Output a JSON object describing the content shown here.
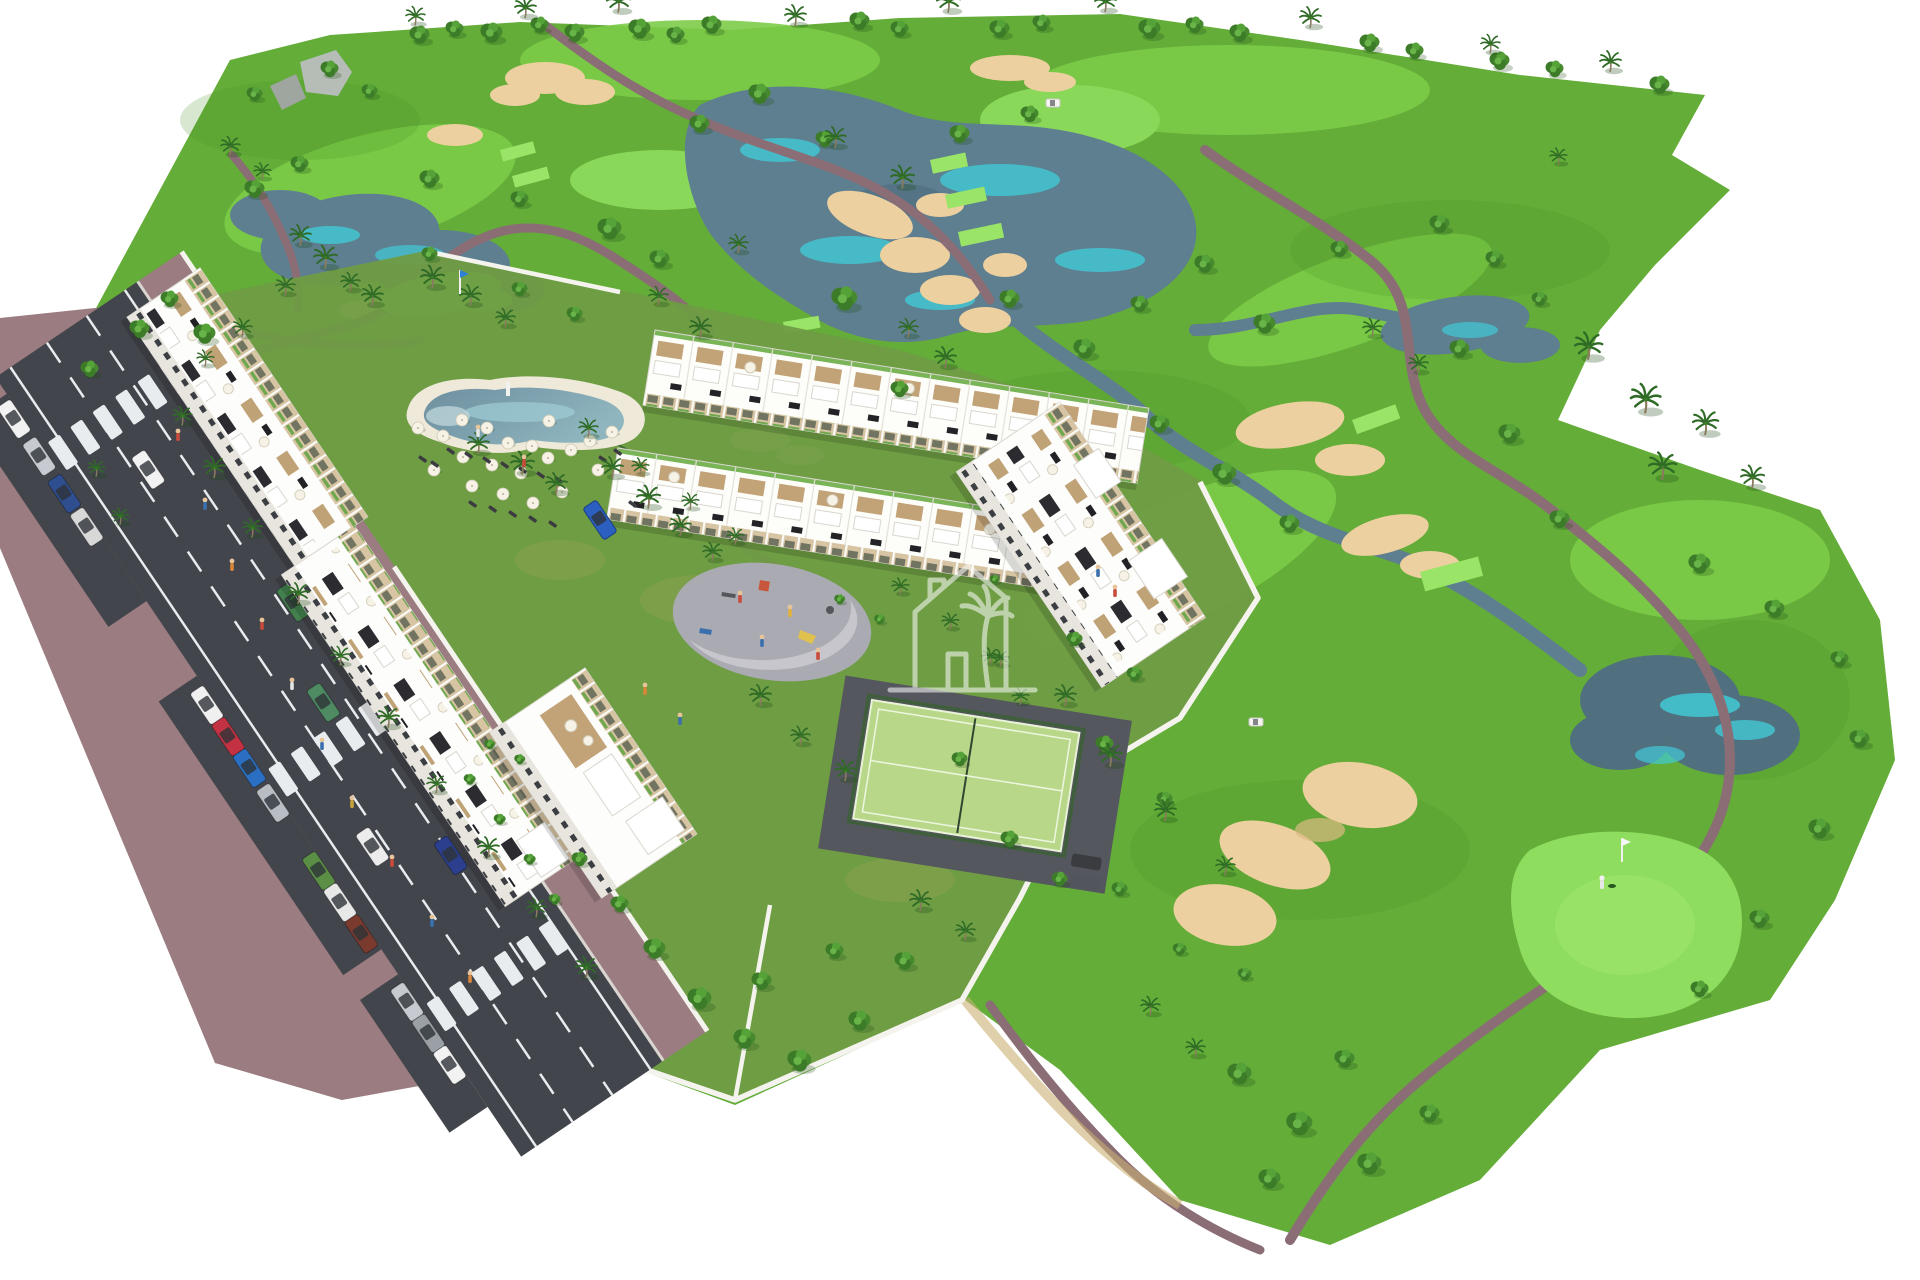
{
  "meta": {
    "title": "Aerial 3D architectural render of a golf resort residential development",
    "scene_type": "computer-generated aerial masterplan visualization",
    "background": "#ffffff"
  },
  "colors": {
    "grass_base": "#63ad38",
    "grass_bright": "#7ccc49",
    "grass_light": "#8edd5f",
    "grass_dark": "#4c922b",
    "grass_tee": "#9ae468",
    "lawn": "#6f9c44",
    "water": "#5e7f90",
    "water_deep": "#51707f",
    "water_accent": "#41c9d5",
    "sand": "#edd0a0",
    "sand_dark": "#ddb985",
    "path": "#8b6d75",
    "road": "#42454b",
    "sidewalk": "#9b7c80",
    "curb": "#d9d5d0",
    "marking": "#e9ecee",
    "wall": "#f5f3ee",
    "building": "#fdfdfb",
    "building_shade": "#e6e2da",
    "facade": "#d7c4a2",
    "roof_dark": "#2c2c30",
    "deck": "#c2a277",
    "green_roof": "#79b457",
    "court": "#b9d788",
    "court_fence": "#3f5f3c",
    "plaza": "#aaaab2",
    "plaza_light": "#c6c6cc",
    "pool_deck": "#efe9da",
    "rock": "#b6bcb6",
    "watermark": "#ffffff",
    "tree": "#3c7c28",
    "palm": "#2f6b26",
    "flag_blue": "#2f7fd6",
    "flag_white": "#f6f6f6"
  },
  "landmarks": {
    "golf_course": "18-hole golf course with lakes, sand bunkers and cart paths",
    "apartments": "white apartment blocks along access road",
    "townhouses": "two rows of townhouses with roof terraces",
    "pool": "lagoon-style swimming pool with sun loungers",
    "padel_court": "fenced padel court",
    "playground": "children's playground plaza",
    "road": "two-lane access road with parallel parking",
    "watermark": "house-with-palm developer watermark"
  },
  "scene": {
    "crosswalks": [
      40,
      434,
      717
    ],
    "trees": [
      [
        420,
        36,
        1.0
      ],
      [
        455,
        30,
        0.9
      ],
      [
        492,
        34,
        1.1
      ],
      [
        540,
        26,
        0.9
      ],
      [
        575,
        34,
        1.0
      ],
      [
        640,
        30,
        1.1
      ],
      [
        676,
        36,
        0.9
      ],
      [
        712,
        26,
        1.0
      ],
      [
        860,
        22,
        1.0
      ],
      [
        900,
        30,
        0.9
      ],
      [
        1000,
        30,
        1.0
      ],
      [
        1042,
        24,
        0.9
      ],
      [
        1150,
        30,
        1.1
      ],
      [
        1195,
        26,
        0.9
      ],
      [
        1240,
        34,
        1.0
      ],
      [
        1370,
        44,
        1.0
      ],
      [
        1415,
        52,
        0.9
      ],
      [
        1500,
        62,
        1.0
      ],
      [
        1555,
        70,
        0.9
      ],
      [
        1660,
        86,
        1.0
      ],
      [
        140,
        330,
        1.0
      ],
      [
        170,
        300,
        0.9
      ],
      [
        205,
        335,
        1.1
      ],
      [
        90,
        370,
        0.9
      ],
      [
        255,
        190,
        1.0
      ],
      [
        300,
        165,
        0.9
      ],
      [
        430,
        180,
        1.0
      ],
      [
        520,
        200,
        0.9
      ],
      [
        610,
        230,
        1.2
      ],
      [
        660,
        260,
        1.0
      ],
      [
        700,
        125,
        1.0
      ],
      [
        760,
        95,
        1.1
      ],
      [
        825,
        140,
        0.9
      ],
      [
        960,
        135,
        1.0
      ],
      [
        1030,
        115,
        0.9
      ],
      [
        845,
        300,
        1.3
      ],
      [
        1010,
        300,
        1.0
      ],
      [
        1085,
        350,
        1.1
      ],
      [
        1140,
        305,
        0.9
      ],
      [
        1205,
        265,
        1.0
      ],
      [
        1265,
        325,
        1.1
      ],
      [
        1160,
        425,
        1.0
      ],
      [
        1225,
        475,
        1.2
      ],
      [
        1290,
        525,
        1.0
      ],
      [
        900,
        390,
        0.9
      ],
      [
        1340,
        250,
        0.9
      ],
      [
        1440,
        225,
        1.0
      ],
      [
        1495,
        260,
        0.9
      ],
      [
        1540,
        300,
        0.8
      ],
      [
        1460,
        350,
        1.0
      ],
      [
        1510,
        435,
        1.1
      ],
      [
        1560,
        520,
        1.0
      ],
      [
        1700,
        565,
        1.1
      ],
      [
        1775,
        610,
        1.0
      ],
      [
        1840,
        660,
        0.9
      ],
      [
        1860,
        740,
        1.0
      ],
      [
        1820,
        830,
        1.1
      ],
      [
        1760,
        920,
        1.0
      ],
      [
        1700,
        990,
        0.9
      ],
      [
        1240,
        1075,
        1.2
      ],
      [
        1300,
        1125,
        1.3
      ],
      [
        1370,
        1165,
        1.2
      ],
      [
        1430,
        1115,
        1.0
      ],
      [
        1345,
        1060,
        1.0
      ],
      [
        1270,
        1180,
        1.1
      ],
      [
        1180,
        950,
        0.7
      ],
      [
        1245,
        975,
        0.7
      ],
      [
        1120,
        890,
        0.8
      ],
      [
        655,
        950,
        1.1
      ],
      [
        700,
        1000,
        1.2
      ],
      [
        745,
        1040,
        1.1
      ],
      [
        800,
        1062,
        1.2
      ],
      [
        860,
        1022,
        1.1
      ],
      [
        905,
        962,
        1.0
      ],
      [
        835,
        952,
        0.9
      ],
      [
        762,
        982,
        1.0
      ],
      [
        620,
        905,
        0.9
      ],
      [
        580,
        860,
        0.8
      ],
      [
        1010,
        840,
        0.9
      ],
      [
        1060,
        880,
        0.8
      ],
      [
        960,
        760,
        0.8
      ],
      [
        1105,
        745,
        0.9
      ],
      [
        1165,
        800,
        0.8
      ],
      [
        330,
        70,
        0.9
      ],
      [
        370,
        92,
        0.8
      ],
      [
        255,
        95,
        0.8
      ],
      [
        1075,
        640,
        0.8
      ],
      [
        1135,
        675,
        0.8
      ],
      [
        430,
        255,
        0.8
      ],
      [
        520,
        290,
        0.8
      ],
      [
        575,
        315,
        0.8
      ],
      [
        470,
        780,
        0.6
      ],
      [
        500,
        820,
        0.6
      ],
      [
        530,
        860,
        0.6
      ],
      [
        555,
        900,
        0.6
      ],
      [
        520,
        760,
        0.55
      ],
      [
        490,
        745,
        0.55
      ],
      [
        840,
        600,
        0.55
      ],
      [
        880,
        620,
        0.55
      ],
      [
        995,
        580,
        0.5
      ]
    ],
    "palms": [
      [
        415,
        20,
        0.9
      ],
      [
        525,
        12,
        1.0
      ],
      [
        618,
        6,
        1.1
      ],
      [
        795,
        20,
        1.0
      ],
      [
        948,
        6,
        1.1
      ],
      [
        1105,
        6,
        1.0
      ],
      [
        1310,
        22,
        1.0
      ],
      [
        1490,
        48,
        0.9
      ],
      [
        1610,
        66,
        1.0
      ],
      [
        1558,
        160,
        0.8
      ],
      [
        300,
        240,
        1.0
      ],
      [
        325,
        262,
        1.1
      ],
      [
        350,
        286,
        0.9
      ],
      [
        285,
        290,
        0.9
      ],
      [
        230,
        150,
        0.9
      ],
      [
        262,
        175,
        0.8
      ],
      [
        372,
        300,
        1.0
      ],
      [
        432,
        282,
        1.1
      ],
      [
        470,
        300,
        1.0
      ],
      [
        505,
        322,
        0.9
      ],
      [
        242,
        332,
        0.9
      ],
      [
        205,
        362,
        0.8
      ],
      [
        835,
        142,
        1.0
      ],
      [
        902,
        182,
        1.1
      ],
      [
        945,
        362,
        1.0
      ],
      [
        908,
        332,
        0.9
      ],
      [
        738,
        248,
        0.9
      ],
      [
        700,
        332,
        1.0
      ],
      [
        658,
        300,
        0.9
      ],
      [
        182,
        420,
        0.9
      ],
      [
        214,
        472,
        1.0
      ],
      [
        252,
        532,
        0.9
      ],
      [
        298,
        598,
        1.0
      ],
      [
        340,
        660,
        0.9
      ],
      [
        388,
        722,
        1.0
      ],
      [
        436,
        788,
        0.9
      ],
      [
        488,
        852,
        1.0
      ],
      [
        536,
        912,
        0.9
      ],
      [
        586,
        972,
        1.0
      ],
      [
        120,
        520,
        0.8
      ],
      [
        96,
        472,
        0.8
      ],
      [
        478,
        448,
        1.0
      ],
      [
        522,
        468,
        1.1
      ],
      [
        556,
        488,
        1.0
      ],
      [
        588,
        432,
        0.9
      ],
      [
        612,
        472,
        1.0
      ],
      [
        648,
        502,
        1.1
      ],
      [
        680,
        530,
        1.0
      ],
      [
        712,
        556,
        0.9
      ],
      [
        760,
        700,
        1.0
      ],
      [
        800,
        740,
        0.9
      ],
      [
        845,
        775,
        1.0
      ],
      [
        1065,
        700,
        1.0
      ],
      [
        1110,
        760,
        1.1
      ],
      [
        1165,
        815,
        1.0
      ],
      [
        1225,
        870,
        0.9
      ],
      [
        920,
        905,
        1.0
      ],
      [
        965,
        935,
        0.9
      ],
      [
        1020,
        700,
        0.8
      ],
      [
        990,
        660,
        0.8
      ],
      [
        1588,
        352,
        1.3
      ],
      [
        1645,
        405,
        1.4
      ],
      [
        1705,
        428,
        1.2
      ],
      [
        1662,
        472,
        1.3
      ],
      [
        1752,
        482,
        1.1
      ],
      [
        1372,
        332,
        0.9
      ],
      [
        1418,
        368,
        0.9
      ],
      [
        1150,
        1010,
        0.9
      ],
      [
        1195,
        1052,
        0.9
      ],
      [
        640,
        470,
        0.8
      ],
      [
        690,
        505,
        0.8
      ],
      [
        735,
        540,
        0.8
      ],
      [
        900,
        590,
        0.8
      ],
      [
        950,
        625,
        0.8
      ],
      [
        1000,
        662,
        0.8
      ]
    ],
    "umbrellas": [
      [
        418,
        428
      ],
      [
        443,
        436
      ],
      [
        462,
        420
      ],
      [
        487,
        428
      ],
      [
        508,
        443
      ],
      [
        532,
        446
      ],
      [
        463,
        457
      ],
      [
        492,
        465
      ],
      [
        521,
        473
      ],
      [
        548,
        458
      ],
      [
        571,
        450
      ],
      [
        590,
        441
      ],
      [
        612,
        432
      ],
      [
        549,
        421
      ],
      [
        434,
        470
      ],
      [
        472,
        486
      ],
      [
        503,
        494
      ],
      [
        533,
        503
      ],
      [
        562,
        492
      ],
      [
        598,
        470
      ]
    ],
    "loungers": [
      [
        448,
        447
      ],
      [
        466,
        451
      ],
      [
        484,
        456
      ],
      [
        502,
        461
      ],
      [
        520,
        466
      ],
      [
        538,
        471
      ],
      [
        556,
        476
      ],
      [
        470,
        500
      ],
      [
        490,
        505
      ],
      [
        510,
        510
      ],
      [
        530,
        515
      ],
      [
        550,
        520
      ],
      [
        420,
        455
      ],
      [
        432,
        460
      ],
      [
        600,
        455
      ],
      [
        615,
        448
      ],
      [
        630,
        500
      ],
      [
        645,
        492
      ]
    ],
    "parked_cars": [
      [
        -15,
        178,
        "#f2f2f2"
      ],
      [
        30,
        178,
        "#c7cbd1"
      ],
      [
        75,
        178,
        "#2e4e8f"
      ],
      [
        115,
        178,
        "#d8d8d8"
      ],
      [
        330,
        178,
        "#f0f0f0"
      ],
      [
        368,
        178,
        "#c23243"
      ],
      [
        406,
        178,
        "#2b6fc2"
      ],
      [
        448,
        178,
        "#b9bec5"
      ],
      [
        530,
        178,
        "#5c8f46"
      ],
      [
        568,
        178,
        "#e8e8e8"
      ],
      [
        606,
        178,
        "#7a3a2e"
      ],
      [
        688,
        178,
        "#c7cbd1"
      ],
      [
        726,
        178,
        "#9aa0a6"
      ],
      [
        764,
        178,
        "#f2f2f2"
      ]
    ],
    "moving_cars": [
      [
        102,
        95,
        "#f2f2f2"
      ],
      [
        293,
        49,
        "#44804e"
      ],
      [
        393,
        80,
        "#4e8a62"
      ],
      [
        591,
        60,
        "#2b3f8e"
      ],
      [
        540,
        120,
        "#ececec"
      ]
    ],
    "people": [
      [
        178,
        436,
        "#c84b3c"
      ],
      [
        205,
        505,
        "#3a6fae"
      ],
      [
        232,
        566,
        "#d9863a"
      ],
      [
        262,
        625,
        "#c84b3c"
      ],
      [
        292,
        685,
        "#e6e6e6"
      ],
      [
        322,
        745,
        "#3a6fae"
      ],
      [
        352,
        803,
        "#c8a23c"
      ],
      [
        392,
        862,
        "#c84b3c"
      ],
      [
        432,
        922,
        "#3a6fae"
      ],
      [
        470,
        978,
        "#d9863a"
      ],
      [
        740,
        598,
        "#c84b3c"
      ],
      [
        762,
        642,
        "#3a6fae"
      ],
      [
        790,
        612,
        "#e4b13e"
      ],
      [
        818,
        655,
        "#c84b3c"
      ],
      [
        478,
        432,
        "#e6e6e6"
      ],
      [
        524,
        462,
        "#c84b3c"
      ],
      [
        1098,
        572,
        "#3a6fae"
      ],
      [
        1115,
        592,
        "#c84b3c"
      ],
      [
        645,
        690,
        "#d9863a"
      ],
      [
        680,
        720,
        "#3a6fae"
      ]
    ],
    "flags": [
      {
        "x": 460,
        "y": 270,
        "color": "#2f7fd6"
      },
      {
        "x": 1622,
        "y": 838,
        "color": "#f6f6f6"
      }
    ],
    "golfer": [
      1602,
      884
    ],
    "carts": [
      [
        1256,
        722
      ],
      [
        1053,
        103
      ]
    ]
  }
}
